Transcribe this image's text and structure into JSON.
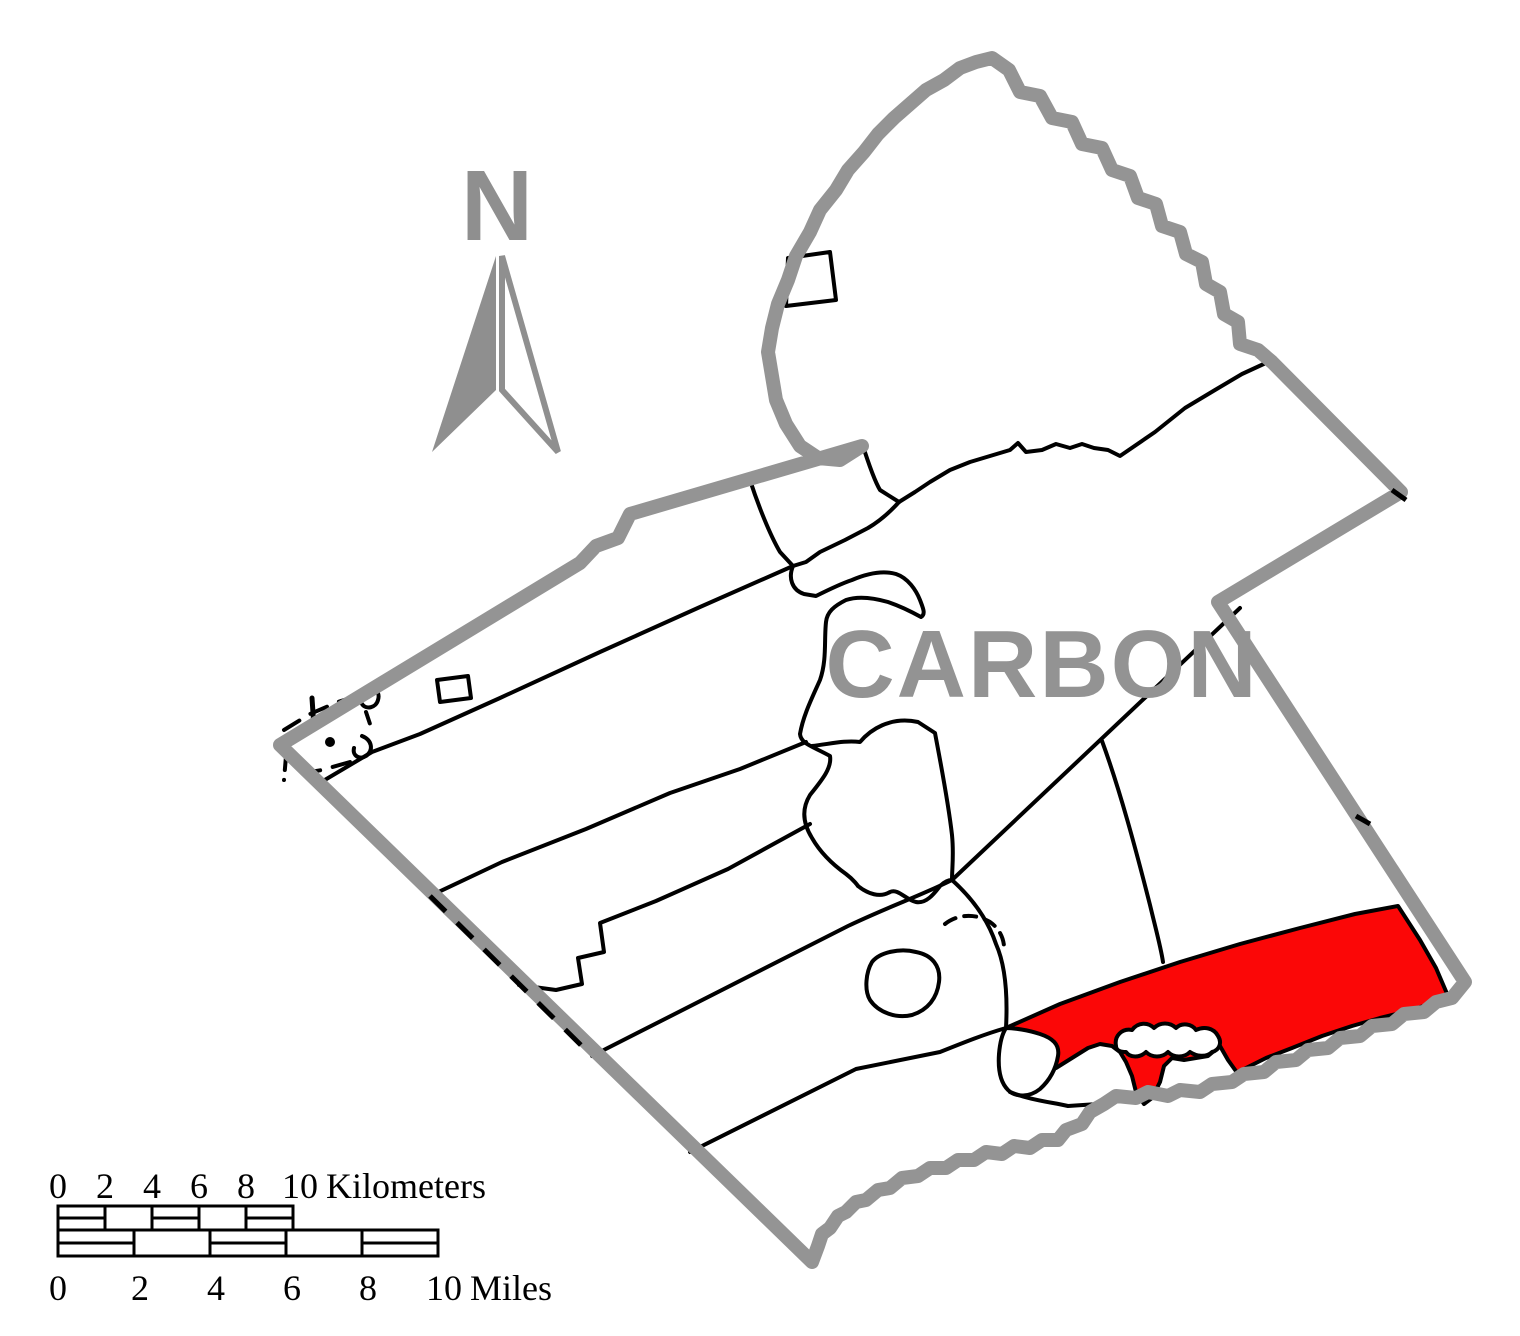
{
  "map": {
    "county_label": "CARBON"
  },
  "north_arrow": {
    "label": "N"
  },
  "colors": {
    "county_border": "#949494",
    "map_label_gray": "#939393",
    "north_arrow_gray": "#8f8f8f",
    "highlight_red": "#fb0707",
    "boundary_black": "#000000",
    "background": "#ffffff"
  },
  "scale_bar": {
    "kilometers": {
      "ticks": [
        "0",
        "2",
        "4",
        "6",
        "8",
        "10"
      ],
      "unit_label": "Kilometers"
    },
    "miles": {
      "ticks": [
        "0",
        "2",
        "4",
        "6",
        "8",
        "10"
      ],
      "unit_label": "Miles"
    }
  }
}
